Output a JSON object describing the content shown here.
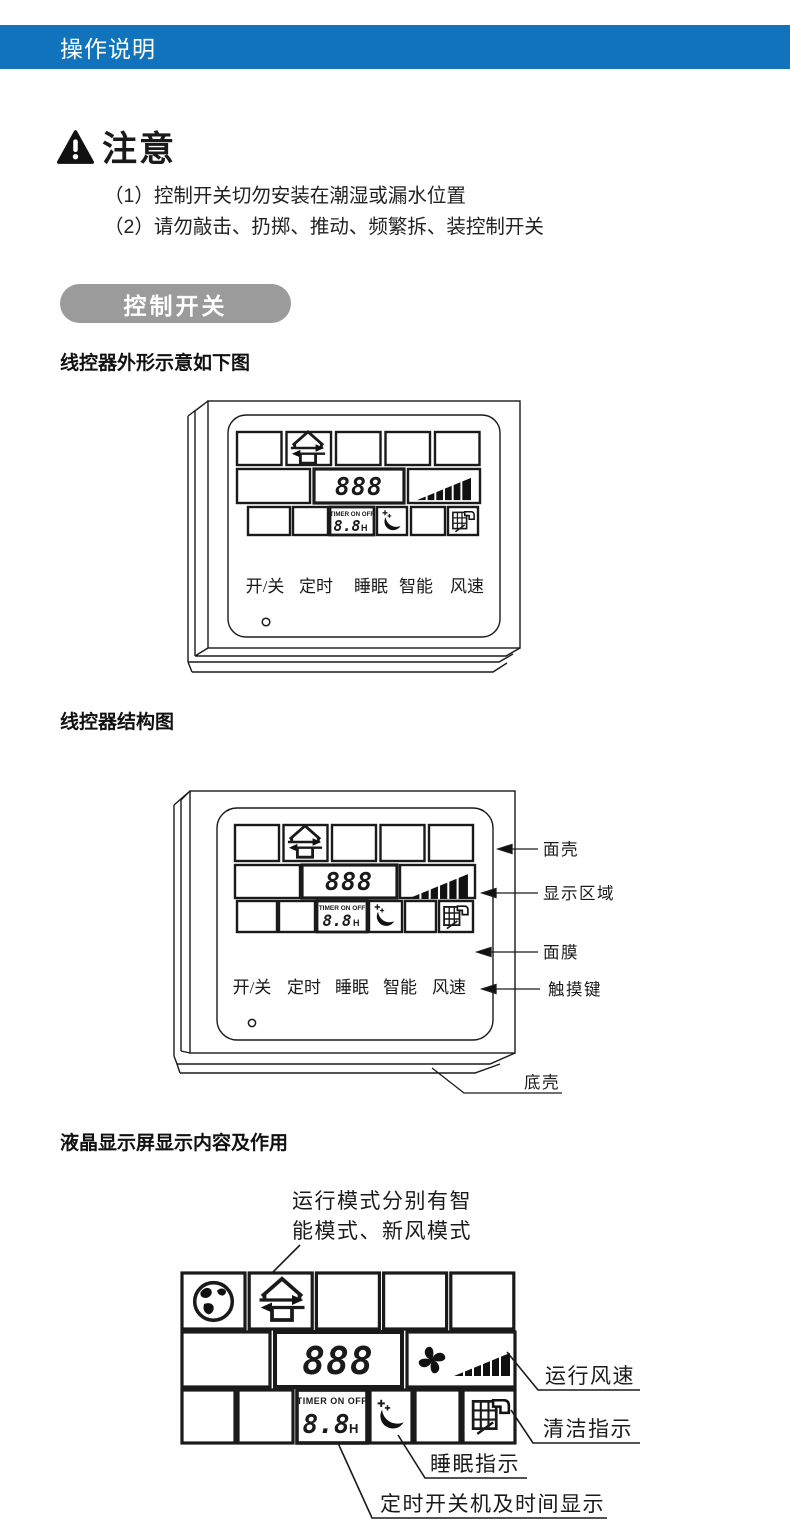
{
  "header": {
    "title": "操作说明",
    "bg_color": "#1273bd"
  },
  "notice": {
    "title": "注意",
    "items": [
      "（1）控制开关切勿安装在潮湿或漏水位置",
      "（2）请勿敲击、扔掷、推动、频繁拆、装控制开关"
    ]
  },
  "section_pill": {
    "label": "控制开关",
    "bg_color": "#9b9b9b"
  },
  "headings": {
    "outline": "线控器外形示意如下图",
    "structure": "线控器结构图",
    "lcd": "液晶显示屏显示内容及作用"
  },
  "display": {
    "digits_main": "888",
    "timer_label": "TIMER ON OFF",
    "timer_digits": "8.8",
    "timer_unit": "H",
    "buttons": [
      "开/关",
      "定时",
      "睡眠",
      "智能",
      "风速"
    ]
  },
  "structure_callouts": {
    "face_shell": "面壳",
    "display_area": "显示区域",
    "membrane": "面膜",
    "touch_keys": "触摸键",
    "bottom_shell": "底壳"
  },
  "lcd_annotations": {
    "mode_line1": "运行模式分别有智",
    "mode_line2": "能模式、新风模式",
    "fan_speed": "运行风速",
    "clean": "清洁指示",
    "sleep": "睡眠指示",
    "timer": "定时开关机及时间显示"
  }
}
